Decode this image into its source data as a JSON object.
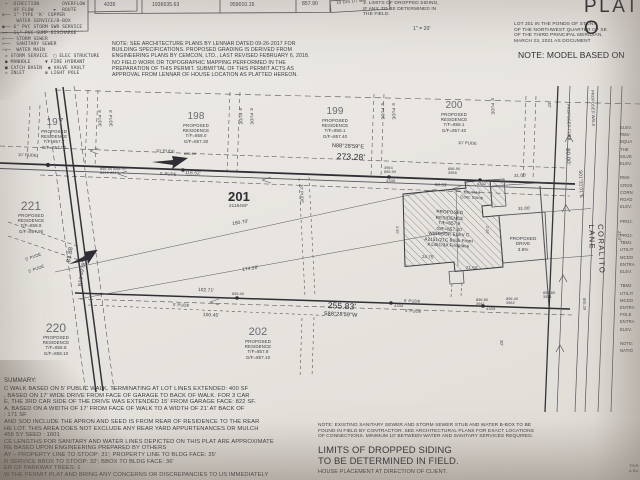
{
  "photo": {
    "paper_color": "#e9e6e1",
    "ink_color": "#3b3a41"
  },
  "legend": {
    "text": "─□─ DROPPED SIDING  ▼ SYMBOL ON LOT\n →  DIRECTION        OVERFLOW\n    OF FLOW       ►  ROUTE\n⊗── 1\" TYPE 'K' COPPER\n     WATER SERVICE/B-BOX\n●── 6\" PVC STORM SWR SERVICE\n──  1¼\" PVC SUMP DISCHARGE\n>─── STORM SEWER\n>──  SANITARY SEWER\n─v─  WATER MAIN\n = STORM SERVICE  □ ELEC STRUCTURE\n ● MANHOLE     ▼ FIRE HYDRANT\n ■ CATCH BASIN  ◉ VALVE VAULT\n ▫ INLET       ⊠ LIGHT POLE"
  },
  "table": {
    "c0": "4335",
    "c1": "1936535.63",
    "c2": "959010.15",
    "c3": "857.90",
    "c4": "10 D/S 1/7 BM"
  },
  "notes": {
    "architecture": "NOTE: SEE ARCHITECTURE PLANS BY LENNAR DATED 09-26-2017 FOR\nBUILDING SPECIFICATIONS. PROPOSED GRADING IS DERIVED FROM\nENGINEERING PLANS BY CEMCON, LTD., LAST REVISED FEBRUARY 6, 2018.\nNO FIELD WORK OR TOPOGRAPHIC MAPPING PERFORMED IN THE\nPREPARATION OF THIS PERMIT. SUBMITTAL OF THIS PERMIT ACTS AS\nAPPROVAL FROM LENNAR OF HOUSE LOCATION AS PLATTED HEREON.",
    "siding": "3. LIMITS OF DROPPED SIDING,\nIF ANY, TO BE DETERMINED IN\nTHE FIELD.",
    "scale": "1\" = 20'",
    "title": "PLAT O",
    "legal": "LOT 201 IN THE PONDS OF STONY\nOF THE NORTHWEST QUARTER OF SE\nOF THE THIRD PRINCIPAL MERIDIAN,\nMARCH 23, 2021 AS DOCUMENT",
    "model": "NOTE: MODEL BASED ON",
    "sewer": "NOTE: EXISTING SANITARY SEWER AND STORM SEWER STUB AND WATER B-BOX TO BE\nFOUND IN FIELD BY CONTRACTOR. SEE ARCHITECTURAL PLANS FOR EXACT LOCATIONS\nOF CONNECTIONS. MINIMUM 10' BETWEEN WATER AND SANITARY SERVICES REQUIRED.",
    "limits": "LIMITS OF DROPPED SIDING\nTO BE DETERMINED IN FIELD.",
    "house": "HOUSE PLACEMENT AT DIRECTION OF CLIENT.",
    "corner": "THIS\nA BU"
  },
  "lots": {
    "l197": {
      "num": "197",
      "details": "PROPOSED\nRESIDENCE\nT/F=857.7\nG/F=857.00"
    },
    "l198": {
      "num": "198",
      "details": "PROPOSED\nRESIDENCE\nT/F=858.0\nG/F=857.30"
    },
    "l199": {
      "num": "199",
      "details": "PROPOSED\nRESIDENCE\nT/F=858.1\nG/F=857.40"
    },
    "l200": {
      "num": "200",
      "details": "PROPOSED\nRESIDENCE\nT/F=858.1\nG/F=857.40"
    },
    "l221": {
      "num": "221",
      "details": "PROPOSED\nRESIDENCE\nT/F=858.8\nG/F=857.90"
    },
    "l220": {
      "num": "220",
      "details": "PROPOSED\nRESIDENCE\nT/F=858.8\nG/F=858.10"
    },
    "l202": {
      "num": "202",
      "details": "PROPOSED\nRESIDENCE\nT/F=857.8\nG/F=857.10"
    },
    "l201": {
      "num": "201",
      "area": "21164SF"
    }
  },
  "building": {
    "text": "PROPOSED\nRESIDENCE\nT/F=857.9\nG/F=857.20\nWINDSOR ELEV C\nA2151/21C Brick Front\nA1351/3A Fireplace",
    "stoop": "Covered\nConc Stoop",
    "drive": "PROPOSED\nDRIVE\n3.8%"
  },
  "bearings": {
    "north": "N88°28'59\"E",
    "north_dist": "273.28'",
    "south_dist": "255.83'",
    "south": "S88°28'59\"W",
    "west_dist": "81.88",
    "west": "N13°49'39\"W",
    "east_dist": "80.00'",
    "east": "S01°31'01\"E"
  },
  "dims": {
    "d11852": "118.52'",
    "d18070": "180.70'",
    "d17428": "174.28'",
    "d10271": "102.71'",
    "d10045": "100.45'",
    "d5033": "50.33'",
    "d3100a": "31.00'",
    "d3100b": "31.00'",
    "d2475": "24.75'",
    "d2158": "21.58'",
    "d210": "21.0'",
    "d300": "3.00'",
    "d200": "2.00'"
  },
  "labels": {
    "p5": "5' PUDE",
    "p10": "10' PUDE",
    "b30": "30'"
  },
  "street": {
    "name": "CORALITO LANE",
    "walk": "PROPOSED WALK",
    "curb": "PROPOSED CURB"
  },
  "marks": {
    "m4335": "4335",
    "m4332": "4332",
    "m4334": "4334",
    "m4333": "4333",
    "e1": "855.50  855.70\n8619  8617",
    "e2": "3954\n855.90",
    "e3": "856.90\n3958",
    "e4": "855.00",
    "e5": "855.00",
    "e6": "856.80\n3941",
    "e7": "856.40\n3962",
    "e8": "855.80\n3541",
    "e9": "855.39"
  },
  "summary": {
    "title": "SUMMARY:",
    "body": "C WALK BASED ON 5' PUBLIC WALK, TERMINATING AT LOT LINES EXTENDED: 400 SF\n, BASED ON 17' WIDE DRIVE FROM FACE OF GARAGE TO BACK OF WALK. FOR 3 CAR\nE, THE 3RD CAR SIDE OF THE DRIVE WAS EXTENDED 15' FROM GARAGE FACE: 822 SF.\nA, BASED ON A WIDTH OF 17' FROM FACE OF WALK TO A WIDTH OF 21' AT BACK OF\n: 171 SF\nAND SOD INCLUDE THE APRON AND SEED IS FROM REAR OF RESIDENCE TO THE REAR\nHE LOT. THIS AREA DOES NOT EXCLUDE ANY REAR YARD APPURTENANCES OR MULCH\n456 SY      SEED : 1601\nCE LENGTHS FOR SANITARY AND WATER LINES DEPICTED ON THIS PLAT ARE APPROXIMATE\nRE BASED UPON ENGINEERING PREPARED BY OTHERS\nAY – PROPERTY LINE TO STOOP: 31'; PROPERTY LINE TO BLDG FACE: 35'\nR SERVICE BBOX TO STOOP: 32'; BBOX TO BLDG FACE: 36'\nER OF PARKWAY TREES: 1\nW THE PERMIT PLAT AND BRING ANY CONCERNS OR DISCREPANCIES TO US IMMEDIATELY"
  },
  "right_column": {
    "text": "ELEV.\nRM1-\nSQUA\nTHE\nSILVE\nELEV.\n\nRM2-\nCROS\nCORN\nROAD\nELEV.\n\nPROJ.\n\nPROJ.\nTBM1\nUTILIT\nMCDO\nENTRA\nELEV.\n\nTBM2\nUTILIT\nMCDO\nENTRA\nPOLE\nENTRA\nELEV.\n\nNOTE:\nNATIO"
  }
}
